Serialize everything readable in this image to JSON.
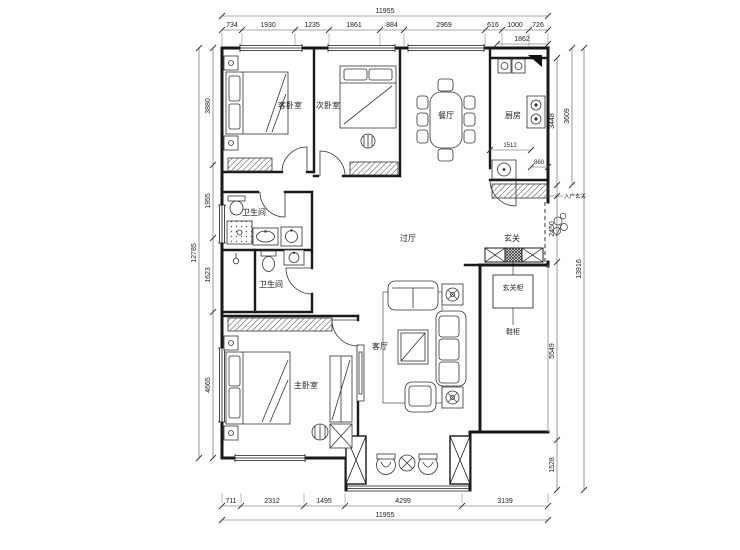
{
  "plan": {
    "rooms": {
      "guest_bedroom": "客卧室",
      "second_bedroom": "次卧室",
      "dining": "餐厅",
      "kitchen": "厨房",
      "hall": "过厅",
      "foyer": "玄关",
      "bath_upper": "卫生间",
      "bath_lower": "卫生间",
      "master_bedroom": "主卧室",
      "living": "客厅",
      "foyer_cabinet": "玄关柜",
      "shoe_cabinet": "鞋柜",
      "entry_note": "入户玄关"
    },
    "dims": {
      "top_total": "11955",
      "top": [
        "734",
        "1930",
        "1235",
        "1861",
        "884",
        "2969",
        "616",
        "1000",
        "726"
      ],
      "top_sub": "1862",
      "bottom": [
        "711",
        "2312",
        "1495",
        "4299",
        "3139"
      ],
      "bottom_total": "11955",
      "left_total": "12785",
      "left": [
        "3880",
        "1955",
        "1623",
        "4665"
      ],
      "right_inner": [
        "3448",
        "2450",
        "5549",
        "1528"
      ],
      "right_outer": [
        "3609",
        "13916"
      ],
      "kitchen": [
        "1512",
        "860"
      ]
    }
  }
}
